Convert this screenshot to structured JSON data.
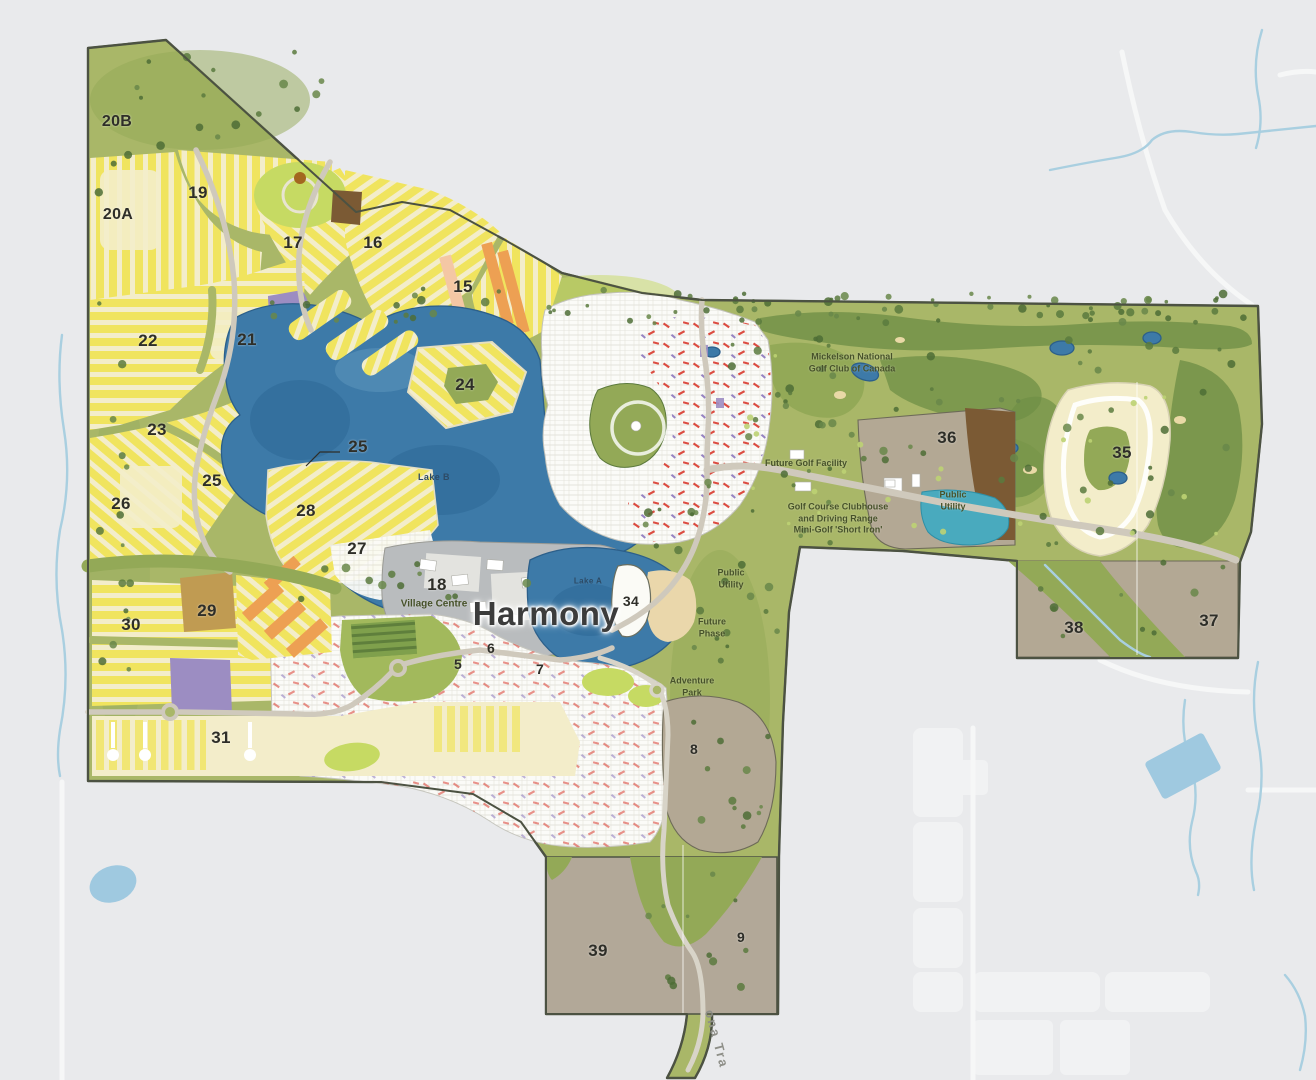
{
  "community": {
    "name": "Harmony"
  },
  "palette": {
    "outside": "#e9eaec",
    "plan-green": "#a9b768",
    "dark-green": "#6f8f46",
    "mid-green": "#93a957",
    "lime": "#c6da63",
    "water": "#3d7aa8",
    "water-dark": "#2e6796",
    "water-edge": "#2c5f8a",
    "teal-pond": "#49aabe",
    "stream": "#a9cfe0",
    "yellow": "#f0e45e",
    "cream": "#f3edca",
    "orange": "#eda053",
    "salmon": "#f4c7a4",
    "purple": "#9c8dc2",
    "brown": "#7b5a34",
    "tan": "#b3a894",
    "beach": "#ead7ab",
    "village-grey": "#b9bcbe",
    "white-lot": "#fbfbf8",
    "road": "#cfc9bc",
    "red": "#d93a2e",
    "boundary": "#4c5242",
    "label-dark": "#2e2e28",
    "label-green": "#47522a",
    "label-lake": "#2d4b66"
  },
  "labels": {
    "parcels": [
      {
        "id": "20B",
        "text": "20B",
        "x": 117,
        "y": 122,
        "size": 16
      },
      {
        "id": "19",
        "text": "19",
        "x": 198,
        "y": 193,
        "size": 17
      },
      {
        "id": "20A",
        "text": "20A",
        "x": 118,
        "y": 215,
        "size": 16
      },
      {
        "id": "17",
        "text": "17",
        "x": 293,
        "y": 243,
        "size": 17
      },
      {
        "id": "16",
        "text": "16",
        "x": 373,
        "y": 243,
        "size": 17
      },
      {
        "id": "15",
        "text": "15",
        "x": 463,
        "y": 287,
        "size": 17
      },
      {
        "id": "22",
        "text": "22",
        "x": 148,
        "y": 341,
        "size": 17
      },
      {
        "id": "21",
        "text": "21",
        "x": 247,
        "y": 340,
        "size": 17
      },
      {
        "id": "24",
        "text": "24",
        "x": 465,
        "y": 385,
        "size": 17
      },
      {
        "id": "23",
        "text": "23",
        "x": 157,
        "y": 430,
        "size": 17
      },
      {
        "id": "25-lake",
        "text": "25",
        "x": 358,
        "y": 447,
        "size": 17
      },
      {
        "id": "25",
        "text": "25",
        "x": 212,
        "y": 481,
        "size": 17
      },
      {
        "id": "26",
        "text": "26",
        "x": 121,
        "y": 504,
        "size": 17
      },
      {
        "id": "28",
        "text": "28",
        "x": 306,
        "y": 511,
        "size": 17
      },
      {
        "id": "27",
        "text": "27",
        "x": 357,
        "y": 549,
        "size": 17
      },
      {
        "id": "18",
        "text": "18",
        "x": 437,
        "y": 585,
        "size": 17
      },
      {
        "id": "34",
        "text": "34",
        "x": 631,
        "y": 601,
        "size": 14
      },
      {
        "id": "29",
        "text": "29",
        "x": 207,
        "y": 611,
        "size": 17
      },
      {
        "id": "30",
        "text": "30",
        "x": 131,
        "y": 625,
        "size": 17
      },
      {
        "id": "31",
        "text": "31",
        "x": 221,
        "y": 738,
        "size": 17
      },
      {
        "id": "5",
        "text": "5",
        "x": 458,
        "y": 664,
        "size": 14
      },
      {
        "id": "6",
        "text": "6",
        "x": 491,
        "y": 648,
        "size": 14
      },
      {
        "id": "7",
        "text": "7",
        "x": 540,
        "y": 669,
        "size": 14
      },
      {
        "id": "8",
        "text": "8",
        "x": 694,
        "y": 749,
        "size": 14
      },
      {
        "id": "36",
        "text": "36",
        "x": 947,
        "y": 438,
        "size": 17
      },
      {
        "id": "35",
        "text": "35",
        "x": 1122,
        "y": 453,
        "size": 17
      },
      {
        "id": "38",
        "text": "38",
        "x": 1074,
        "y": 628,
        "size": 17
      },
      {
        "id": "37",
        "text": "37",
        "x": 1209,
        "y": 621,
        "size": 17
      },
      {
        "id": "39",
        "text": "39",
        "x": 598,
        "y": 951,
        "size": 17
      },
      {
        "id": "9",
        "text": "9",
        "x": 741,
        "y": 937,
        "size": 14
      }
    ],
    "places": [
      {
        "id": "golf-club-name",
        "lines": [
          "Mickelson National",
          "Golf Club of Canada"
        ],
        "x": 852,
        "y": 363,
        "size": 9
      },
      {
        "id": "future-golf-facility",
        "lines": [
          "Future Golf Facility"
        ],
        "x": 806,
        "y": 464,
        "size": 9
      },
      {
        "id": "clubhouse",
        "lines": [
          "Golf Course Clubhouse",
          "and Driving Range",
          "Mini-Golf 'Short Iron'"
        ],
        "x": 838,
        "y": 519,
        "size": 9
      },
      {
        "id": "public-utility-east",
        "lines": [
          "Public",
          "Utility"
        ],
        "x": 953,
        "y": 501,
        "size": 9
      },
      {
        "id": "public-utility-south",
        "lines": [
          "Public",
          "Utility"
        ],
        "x": 731,
        "y": 579,
        "size": 9
      },
      {
        "id": "future-phase",
        "lines": [
          "Future",
          "Phase"
        ],
        "x": 712,
        "y": 628,
        "size": 9
      },
      {
        "id": "adventure-park",
        "lines": [
          "Adventure",
          "Park"
        ],
        "x": 692,
        "y": 687,
        "size": 9
      },
      {
        "id": "village-centre",
        "lines": [
          "Village Centre"
        ],
        "x": 434,
        "y": 604,
        "size": 10
      }
    ],
    "lakes": [
      {
        "id": "lake-b",
        "text": "Lake B",
        "x": 434,
        "y": 477,
        "size": 9
      },
      {
        "id": "lake-a",
        "text": "Lake A",
        "x": 588,
        "y": 581,
        "size": 8
      }
    ],
    "community": {
      "text": "Harmony",
      "x": 546,
      "y": 614,
      "size": 33
    },
    "road": {
      "text": "ona Tra",
      "x": 717,
      "y": 1039,
      "size": 13,
      "rotation": 75
    }
  }
}
